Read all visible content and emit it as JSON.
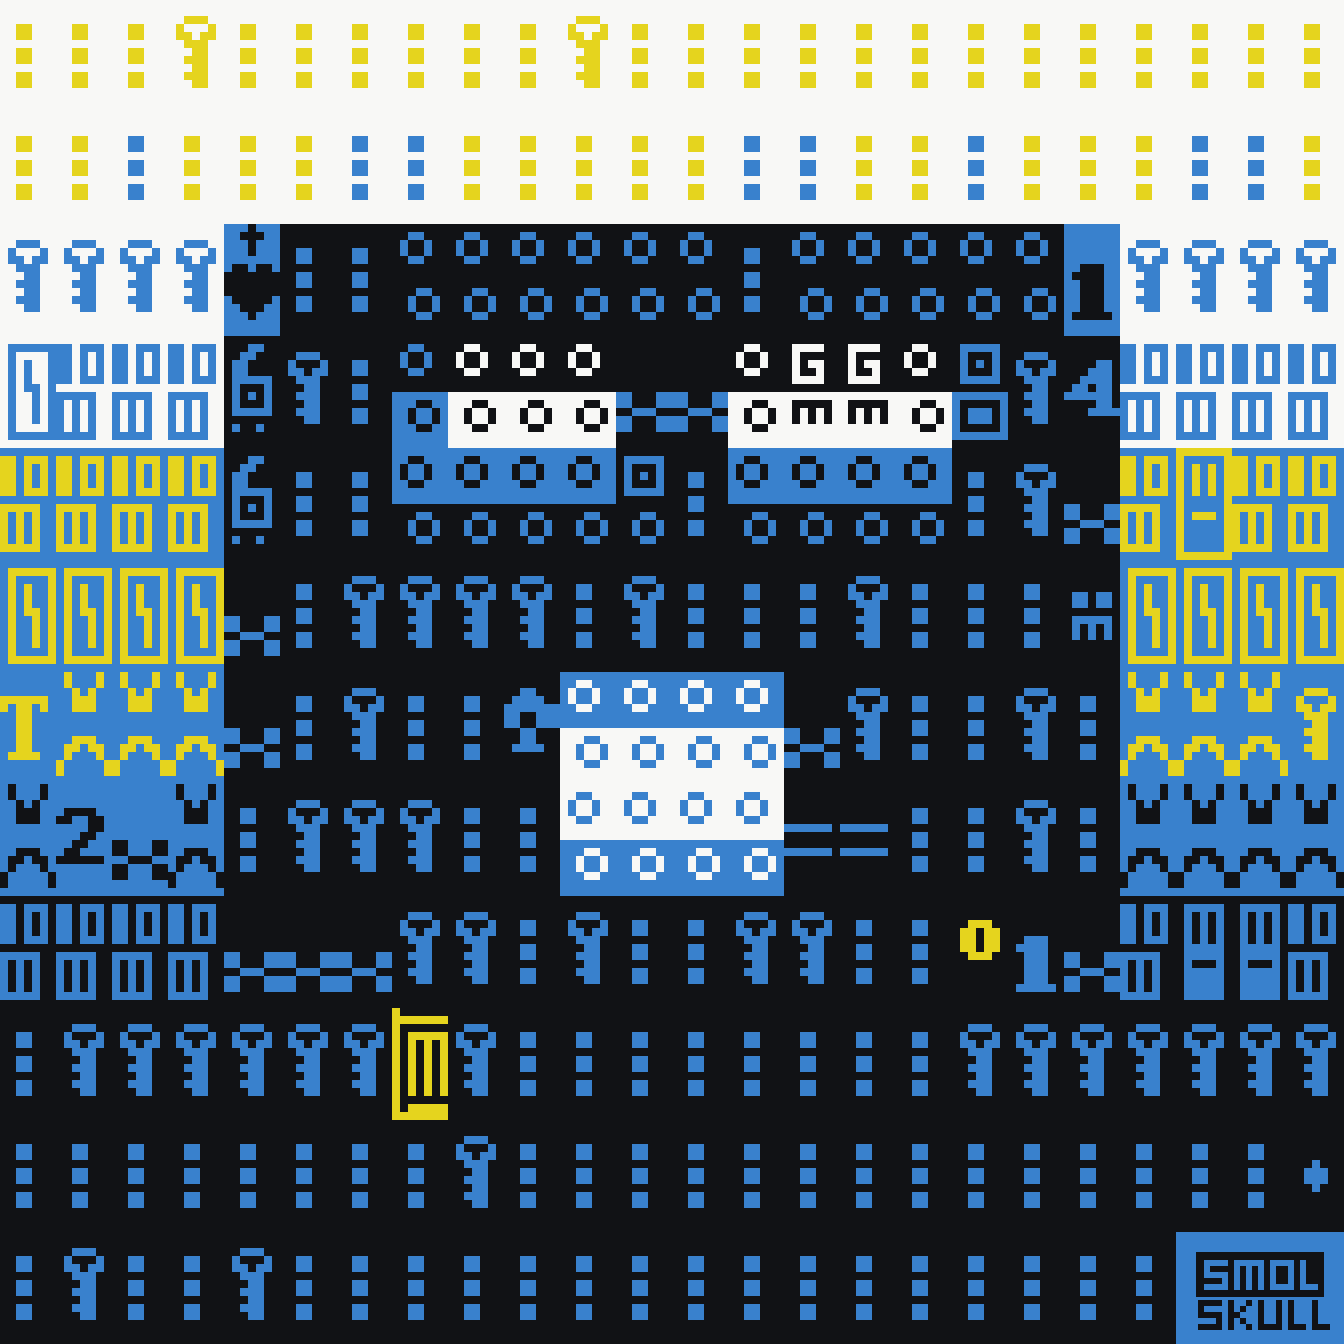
{
  "artwork": {
    "title": "SMOL SKULL textmode pixel artwork",
    "logo": {
      "text": "SMOL SKULL",
      "line1": "SMOL",
      "line2": "SKULL"
    },
    "palette": {
      "W": "#f8f8f6",
      "K": "#111215",
      "B": "#3981cd",
      "Y": "#e5d41e"
    },
    "glyph_legend": {
      "d": "triple-dot-icon",
      "k": "key-icon",
      "oo": "double-ring-icon",
      "hc": "heart-cross-icon",
      "6": "six-creature-icon",
      "bb": "double-box-icon",
      "BB": "hook-box-icon",
      "bI": "barred-window-icon",
      "T": "letter-T-glyph",
      "vx": "split-x-glyph",
      "x": "x-cross-icon",
      "2": "digit-2-glyph",
      "1": "digit-1-glyph",
      "4": "digit-4-glyph",
      "Gm": "G-over-m-glyph",
      "sq": "square-ring-pair-icon",
      "qo": "square-over-ring-icon",
      "an": "anchor-cross-icon",
      "em": "tiny-face-icon",
      "eq": "double-bar-icon",
      "O": "big-ring-icon",
      "jl": "cage-icon",
      "pl": "clover-plus-icon",
      "-": "empty"
    },
    "grid": {
      "cols": 24,
      "rows": 12,
      "cell_w": 56,
      "cell_h": 112,
      "rows_data": [
        [
          "d:Y:W",
          "d:Y:W",
          "d:Y:W",
          "k:Y:W",
          "d:Y:W",
          "d:Y:W",
          "d:Y:W",
          "d:Y:W",
          "d:Y:W",
          "d:Y:W",
          "k:Y:W",
          "d:Y:W",
          "d:Y:W",
          "d:Y:W",
          "d:Y:W",
          "d:Y:W",
          "d:Y:W",
          "d:Y:W",
          "d:Y:W",
          "d:Y:W",
          "d:Y:W",
          "d:Y:W",
          "d:Y:W",
          "d:Y:W"
        ],
        [
          "d:Y:W",
          "d:Y:W",
          "d:B:W",
          "d:Y:W",
          "d:Y:W",
          "d:Y:W",
          "d:B:W",
          "d:B:W",
          "d:Y:W",
          "d:Y:W",
          "d:Y:W",
          "d:Y:W",
          "d:Y:W",
          "d:B:W",
          "d:B:W",
          "d:Y:W",
          "d:Y:W",
          "d:B:W",
          "d:Y:W",
          "d:Y:W",
          "d:Y:W",
          "d:B:W",
          "d:B:W",
          "d:Y:W"
        ],
        [
          "k:B:W",
          "k:B:W",
          "k:B:W",
          "k:B:W",
          "hc:K:B",
          "d:B:K",
          "d:B:K",
          "oo:B:K",
          "oo:B:K",
          "oo:B:K",
          "oo:B:K",
          "oo:B:K",
          "oo:B:K",
          "d:B:K",
          "oo:B:K",
          "oo:B:K",
          "oo:B:K",
          "oo:B:K",
          "oo:B:K",
          "1:K:B",
          "k:B:W",
          "k:B:W",
          "k:B:W",
          "k:B:W"
        ],
        [
          "BB:B:W",
          "bb:B:W",
          "bb:B:W",
          "bb:B:W",
          "6:B:K",
          "k:B:K",
          "d:B:K",
          "oo:B/K:K/B",
          "oo:W/K:K/W",
          "oo:W/K:K/W",
          "oo:W/K:K/W",
          "x:B:K",
          "x:B:K",
          "oo:W/K:K/W",
          "Gm:W/K:K/W",
          "Gm:W/K:K/W",
          "oo:W/K:K/W",
          "sq:B:K",
          "k:B:K",
          "4:B:K",
          "bb:B:W",
          "bb:B:W",
          "bb:B:W",
          "bb:B:W"
        ],
        [
          "bb:Y:B",
          "bb:Y:B",
          "bb:Y:B",
          "bb:Y:B",
          "6:B:K",
          "d:B:K",
          "d:B:K",
          "oo:K/B:B/K",
          "oo:K/B:B/K",
          "oo:K/B:B/K",
          "oo:K/B:B/K",
          "qo:B:K",
          "d:B:K",
          "oo:K/B:B/K",
          "oo:K/B:B/K",
          "oo:K/B:B/K",
          "oo:K/B:B/K",
          "d:B:K",
          "k:B:K",
          "x:B:K",
          "bb:Y:B",
          "bI:Y:B",
          "bb:Y:B",
          "bb:Y:B"
        ],
        [
          "BB:Y:B",
          "BB:Y:B",
          "BB:Y:B",
          "BB:Y:B",
          "x:B:K",
          "d:B:K",
          "k:B:K",
          "k:B:K",
          "k:B:K",
          "k:B:K",
          "d:B:K",
          "k:B:K",
          "d:B:K",
          "d:B:K",
          "d:B:K",
          "k:B:K",
          "d:B:K",
          "d:B:K",
          "d:B:K",
          "em:B:K",
          "BB:Y:B",
          "BB:Y:B",
          "BB:Y:B",
          "BB:Y:B"
        ],
        [
          "T:Y:B",
          "vx:Y:B",
          "vx:Y:B",
          "vx:Y:B",
          "x:B:K",
          "d:B:K",
          "k:B:K",
          "d:B:K",
          "d:B:K",
          "an:B:K",
          "oo:W/B:B/W",
          "oo:W/B:B/W",
          "oo:W/B:B/W",
          "oo:W/B:B/W",
          "x:B:K",
          "k:B:K",
          "d:B:K",
          "d:B:K",
          "k:B:K",
          "d:B:K",
          "vx:Y:B",
          "vx:Y:B",
          "vx:Y:B",
          "k:Y:B"
        ],
        [
          "vx:K:B",
          "2:K:B",
          "x:K:B",
          "vx:K:B",
          "d:B:K",
          "k:B:K",
          "k:B:K",
          "k:B:K",
          "d:B:K",
          "d:B:K",
          "oo:B/W:W/B",
          "oo:B/W:W/B",
          "oo:B/W:W/B",
          "oo:B/W:W/B",
          "eq:B:K",
          "eq:B:K",
          "d:B:K",
          "d:B:K",
          "k:B:K",
          "d:B:K",
          "vx:K:B",
          "vx:K:B",
          "vx:K:B",
          "vx:K:B"
        ],
        [
          "bb:B:K",
          "bb:B:K",
          "bb:B:K",
          "bb:B:K",
          "x:B:K",
          "x:B:K",
          "x:B:K",
          "k:B:K",
          "k:B:K",
          "d:B:K",
          "k:B:K",
          "d:B:K",
          "d:B:K",
          "k:B:K",
          "k:B:K",
          "d:B:K",
          "d:B:K",
          "O:Y:K",
          "1:B:K",
          "x:B:K",
          "bb:B:K",
          "bI:K:B",
          "bI:K:B",
          "bb:B:K"
        ],
        [
          "d:B:K",
          "k:B:K",
          "k:B:K",
          "k:B:K",
          "k:B:K",
          "k:B:K",
          "k:B:K",
          "jl:Y:K",
          "k:B:K",
          "d:B:K",
          "d:B:K",
          "d:B:K",
          "d:B:K",
          "d:B:K",
          "d:B:K",
          "d:B:K",
          "d:B:K",
          "k:B:K",
          "k:B:K",
          "k:B:K",
          "k:B:K",
          "k:B:K",
          "k:B:K",
          "k:B:K"
        ],
        [
          "d:B:K",
          "d:B:K",
          "d:B:K",
          "d:B:K",
          "d:B:K",
          "d:B:K",
          "d:B:K",
          "d:B:K",
          "k:B:K",
          "d:B:K",
          "d:B:K",
          "d:B:K",
          "d:B:K",
          "d:B:K",
          "d:B:K",
          "d:B:K",
          "d:B:K",
          "d:B:K",
          "d:B:K",
          "d:B:K",
          "d:B:K",
          "d:B:K",
          "d:B:K",
          "pl:B:K"
        ],
        [
          "d:B:K",
          "k:B:K",
          "d:B:K",
          "d:B:K",
          "k:B:K",
          "d:B:K",
          "d:B:K",
          "d:B:K",
          "d:B:K",
          "d:B:K",
          "d:B:K",
          "d:B:K",
          "d:B:K",
          "d:B:K",
          "d:B:K",
          "d:B:K",
          "d:B:K",
          "d:B:K",
          "d:B:K",
          "d:B:K",
          "d:B:K",
          "-:K:B",
          "-:K:B",
          "-:K:B"
        ]
      ]
    }
  }
}
